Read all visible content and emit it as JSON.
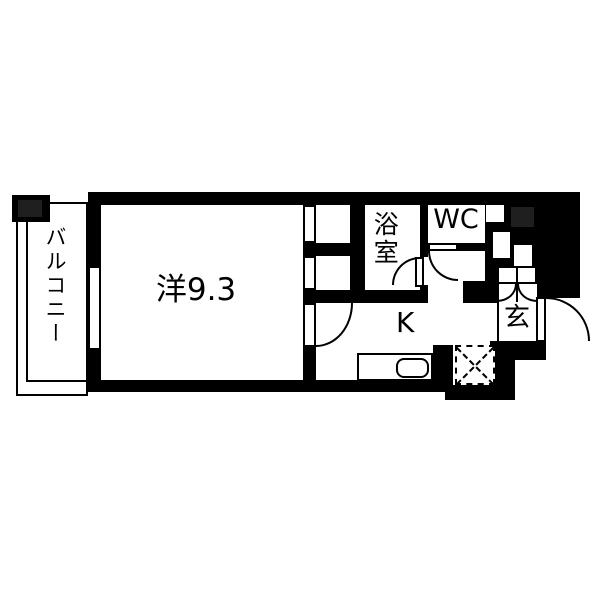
{
  "plan": {
    "rooms": {
      "balcony": {
        "label": "バルコニー"
      },
      "main_room": {
        "label": "洋9.3"
      },
      "bathroom": {
        "label": "浴室"
      },
      "toilet": {
        "label": "WC"
      },
      "kitchen": {
        "label": "K"
      },
      "entrance": {
        "label": "玄"
      }
    },
    "colors": {
      "wall": "#000000",
      "floor": "#ffffff",
      "pillar_shade": "#1f1f1f"
    },
    "fixtures": {
      "kitchen_counter": "kitchen-sink-counter",
      "refrigerator": "refrigerator-space",
      "shoe_cabinet": "shoe-cabinet-double-doors",
      "balcony_pillar": "structural-pillar",
      "window": "balcony-window"
    }
  }
}
